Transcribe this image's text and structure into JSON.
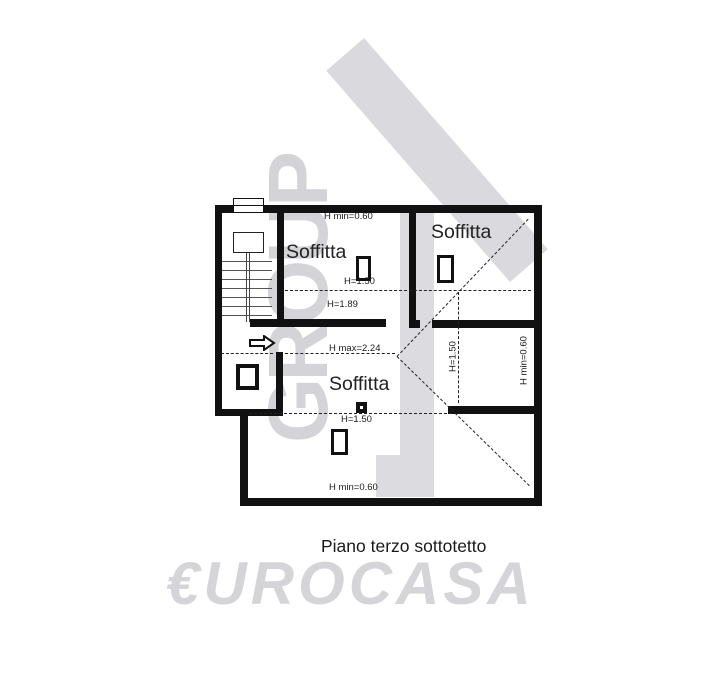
{
  "plan": {
    "rooms": [
      {
        "label": "Soffitta"
      },
      {
        "label": "Soffitta"
      },
      {
        "label": "Soffitta"
      }
    ],
    "dimensions": {
      "top_min_height": "H min=0.60",
      "upper_line_height": "H=1.50",
      "wall_height": "H=1.89",
      "max_height": "H max=2.24",
      "lower_line_height": "H=1.50",
      "bottom_min_height": "H min=0.60",
      "right_line_height": "H=1.50",
      "right_min_height": "H min=0.60"
    }
  },
  "caption": "Piano terzo sottotetto",
  "watermarks": {
    "group_text": "GROUP",
    "logo_text": "€UROCASA"
  },
  "colors": {
    "wall": "#111111",
    "dimension_text": "#1a1a1a",
    "watermark_gray": "#d3d3d8",
    "logo_gray": "#d5d5d9"
  }
}
